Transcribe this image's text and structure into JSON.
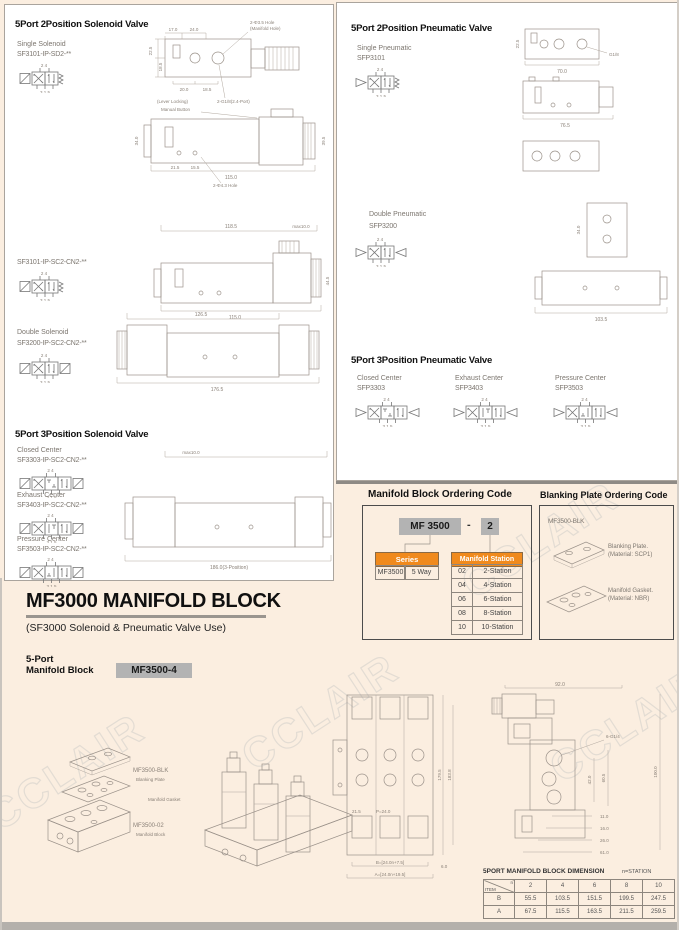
{
  "watermark": {
    "text": "CCLAIR"
  },
  "left_panel": {
    "heading_2pos": "5Port 2Position Solenoid Valve",
    "heading_3pos": "5Port 3Position Solenoid Valve",
    "single": {
      "label": "Single Solenoid",
      "code": "SF3101-IP-SD2-**",
      "sym": {
        "pos": 2,
        "boxes": [
          "x",
          "s"
        ],
        "l": "sol",
        "r": "spr"
      }
    },
    "single_cn": {
      "code": "SF3101-IP-SC2-CN2-**",
      "sym": {
        "pos": 2,
        "boxes": [
          "x",
          "s"
        ],
        "l": "sol",
        "r": "spr"
      }
    },
    "double": {
      "label": "Double Solenoid",
      "code": "SF3200-IP-SC2-CN2-**",
      "sym": {
        "pos": 2,
        "boxes": [
          "x",
          "s"
        ],
        "l": "sol",
        "r": "sol"
      }
    },
    "closed": {
      "label": "Closed Center",
      "code": "SF3303-IP-SC2-CN2-**",
      "sym": {
        "pos": 3,
        "boxes": [
          "x",
          "c",
          "s"
        ],
        "l": "sol",
        "r": "sol"
      }
    },
    "exhaust": {
      "label": "Exhaust Center",
      "code": "SF3403-IP-SC2-CN2-**",
      "sym": {
        "pos": 3,
        "boxes": [
          "x",
          "e",
          "s"
        ],
        "l": "sol",
        "r": "sol"
      }
    },
    "pressure": {
      "label": "Pressure Center",
      "code": "SF3503-IP-SC2-CN2-**",
      "sym": {
        "pos": 3,
        "boxes": [
          "x",
          "p",
          "s"
        ],
        "l": "sol",
        "r": "sol"
      }
    },
    "dims": {
      "top_view": {
        "w1": "17.0",
        "w2": "24.0",
        "h1": "22.5",
        "h2": "18.5",
        "b1": "20.0",
        "b2": "18.5",
        "hole1": "2-Φ3.5 Hole",
        "hole2": "(Manifold Hole)",
        "port": "2-G1/8(2.4-Port)"
      },
      "side_view": {
        "cap1": "(Lever Locking)",
        "cap2": "Manual Button",
        "len": "115.0",
        "h": "34.0",
        "d1": "21.5",
        "d2": "15.5",
        "hole": "2-Φ4.3 Hole",
        "r": "39.5"
      },
      "sc2": {
        "top": "118.5",
        "max": "max10.0",
        "len": "115.0",
        "r": "44.5"
      },
      "dbl": {
        "top": "126.5",
        "len": "176.5"
      },
      "pos3": {
        "max": "max10.0",
        "len": "186.0(3-Position)"
      }
    }
  },
  "right_panel": {
    "heading_2pos": "5Port 2Position Pneumatic Valve",
    "heading_3pos": "5Port 3Position Pneumatic Valve",
    "single": {
      "label": "Single Pneumatic",
      "code": "SFP3101",
      "sym": {
        "pos": 2,
        "boxes": [
          "x",
          "s"
        ],
        "l": "tri",
        "r": "spr"
      }
    },
    "double": {
      "label": "Double Pneumatic",
      "code": "SFP3200",
      "sym": {
        "pos": 2,
        "boxes": [
          "x",
          "s"
        ],
        "l": "tri",
        "r": "tri"
      }
    },
    "closed": {
      "label": "Closed Center",
      "code": "SFP3303",
      "sym": {
        "pos": 3,
        "boxes": [
          "x",
          "c",
          "s"
        ],
        "l": "tri",
        "r": "tri"
      }
    },
    "exhaust": {
      "label": "Exhaust Center",
      "code": "SFP3403",
      "sym": {
        "pos": 3,
        "boxes": [
          "x",
          "e",
          "s"
        ],
        "l": "tri",
        "r": "tri"
      }
    },
    "pressure": {
      "label": "Pressure Center",
      "code": "SFP3503",
      "sym": {
        "pos": 3,
        "boxes": [
          "x",
          "p",
          "s"
        ],
        "l": "tri",
        "r": "tri"
      }
    },
    "dims": {
      "top_w": "70.0",
      "top_h": "22.5",
      "port": "G1/8",
      "side_len": "76.5",
      "dbl_h": "34.0",
      "dbl_len": "103.5"
    }
  },
  "ordering": {
    "manifold_title": "Manifold Block Ordering Code",
    "blanking_title": "Blanking Plate Ordering Code",
    "code_series": "MF 3500",
    "code_dash": "-",
    "code_station": "2",
    "series_header": "Series",
    "series_model": "MF3500",
    "series_way": "5 Way",
    "station_header": "Manifold Station",
    "stations": [
      [
        "02",
        "2-Station"
      ],
      [
        "04",
        "4-Station"
      ],
      [
        "06",
        "6-Station"
      ],
      [
        "08",
        "8-Station"
      ],
      [
        "10",
        "10-Station"
      ]
    ],
    "blk_code": "MF3500-BLK",
    "blanking_plate_1": "Blanking Plate.",
    "blanking_plate_2": "(Material: SCP1)",
    "gasket_1": "Manifold Gasket.",
    "gasket_2": "(Material: NBR)"
  },
  "bottom": {
    "title": "MF3000 MANIFOLD BLOCK",
    "subtitle": "(SF3000 Solenoid & Pneumatic Valve Use)",
    "port1": "5-Port",
    "port2": "Manifold Block",
    "chip": "MF3500-4",
    "exploded": {
      "blk_code": "MF3500-BLK",
      "blk_label": "Blanking Plate",
      "gasket_label": "Manifold Gasket",
      "block_code": "MF3500-02",
      "block_label": "Manifold Block"
    },
    "plan": {
      "left1": "21.5",
      "pitch": "P=24.0",
      "b": "B=[24.0n+7.5]",
      "a": "A=[24.0n+19.5]",
      "right": "6.0",
      "v1": "179.5",
      "v2": "183.8"
    },
    "side": {
      "top": "92.0",
      "right": "100.0",
      "port": "6-G1/4",
      "d1": "42.0",
      "d2": "60.5",
      "b1": "11.0",
      "b2": "16.0",
      "b3": "26.0",
      "b4": "61.0"
    },
    "table": {
      "title": "5PORT MANIFOLD BLOCK DIMENSION",
      "note": "n=STATION",
      "corner_top": "n",
      "corner_item": "ITEM",
      "columns": [
        "2",
        "4",
        "6",
        "8",
        "10"
      ],
      "rows": [
        {
          "item": "B",
          "values": [
            "55.5",
            "103.5",
            "151.5",
            "199.5",
            "247.5"
          ]
        },
        {
          "item": "A",
          "values": [
            "67.5",
            "115.5",
            "163.5",
            "211.5",
            "259.5"
          ]
        }
      ]
    }
  },
  "symbols": {
    "ports_top": "2 4",
    "ports_bottom": "3 1 5"
  },
  "colors": {
    "accent_orange": "#f08a1d",
    "cream": "#fbeee0",
    "chip_gray": "#b3b3b3"
  }
}
